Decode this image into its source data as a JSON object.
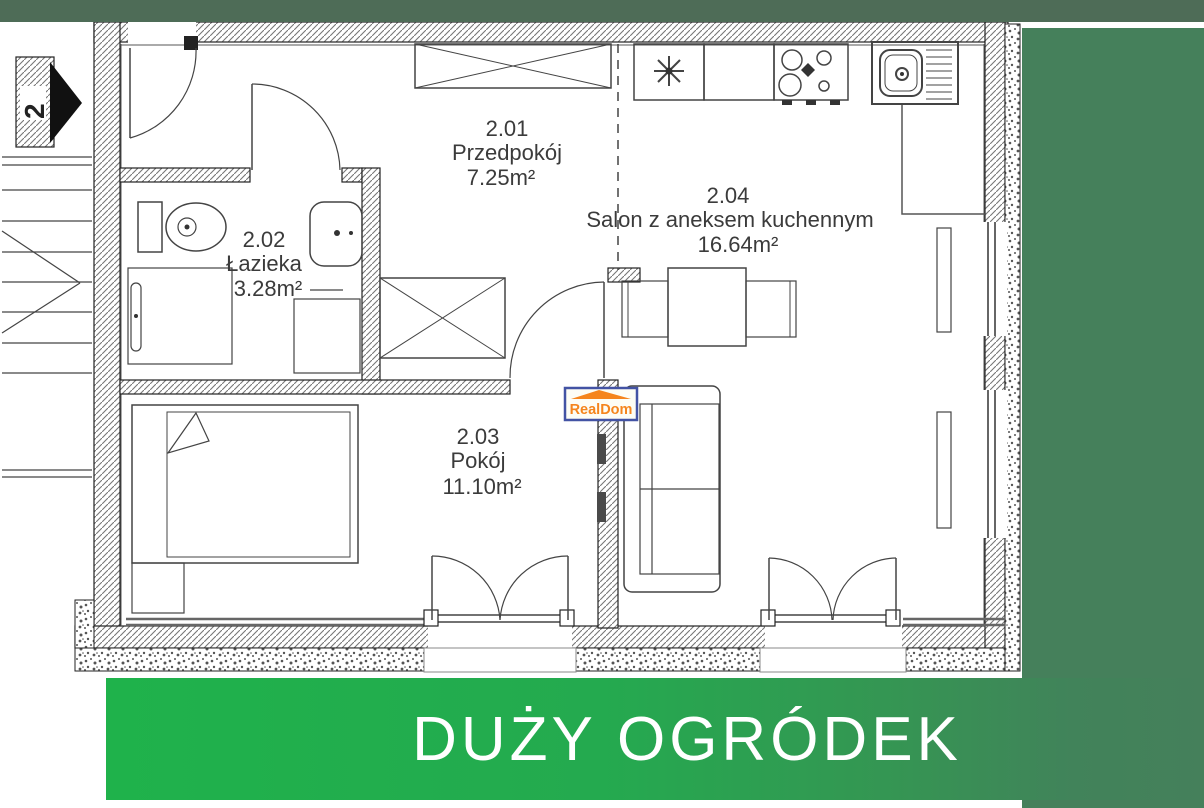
{
  "banner": {
    "text": "DUŻY OGRÓDEK"
  },
  "logo": {
    "text": "RealDom"
  },
  "plan": {
    "stair_label": "2",
    "rooms": [
      {
        "number": "2.01",
        "name": "Przedpokój",
        "area": "7.25m²"
      },
      {
        "number": "2.02",
        "name": "Łazieka",
        "area": "3.28m²"
      },
      {
        "number": "2.03",
        "name": "Pokój",
        "area": "11.10m²"
      },
      {
        "number": "2.04",
        "name": "Salon z aneksem kuchennym",
        "area": "16.64m²"
      }
    ]
  },
  "colors": {
    "top_strip_green": "#4e6c57",
    "garden_panel_green": "#45805b",
    "garden_banner_bright_green": "#1fb24b",
    "banner_text": "#ffffff",
    "logo_border_blue": "#4353a4",
    "logo_orange": "#f5851d",
    "plan_line": "#444444"
  }
}
